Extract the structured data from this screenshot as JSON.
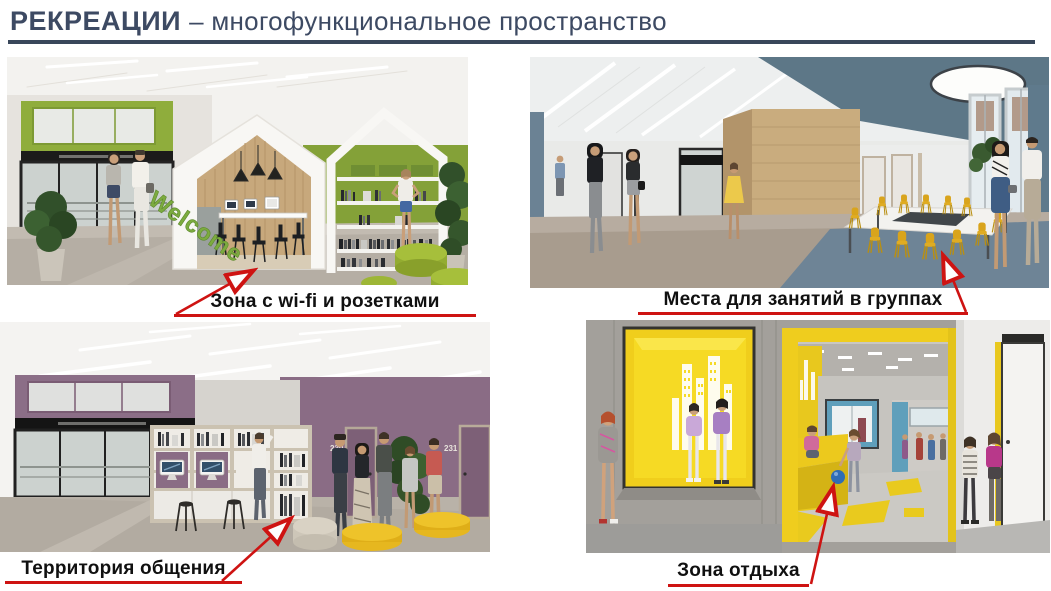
{
  "slide": {
    "title_bold": "РЕКРЕАЦИИ",
    "title_rest": "– многофункциональное пространство"
  },
  "panels": {
    "wifi": {
      "caption": "Зона с wi-fi и розетками",
      "overlay_text": "Welcome"
    },
    "groups": {
      "caption": "Места для занятий в группах"
    },
    "communication": {
      "caption": "Территория общения",
      "door_number_1": "230",
      "door_number_2": "231"
    },
    "rest": {
      "caption": "Зона отдыха"
    }
  },
  "palette": {
    "title_color": "#3d4a63",
    "annotation_red": "#ce1312",
    "green_accent": "#8fad3c",
    "slate_blue": "#5f7a8c",
    "mauve_purple": "#8a6c85",
    "yellow_accent": "#eecd1e"
  }
}
